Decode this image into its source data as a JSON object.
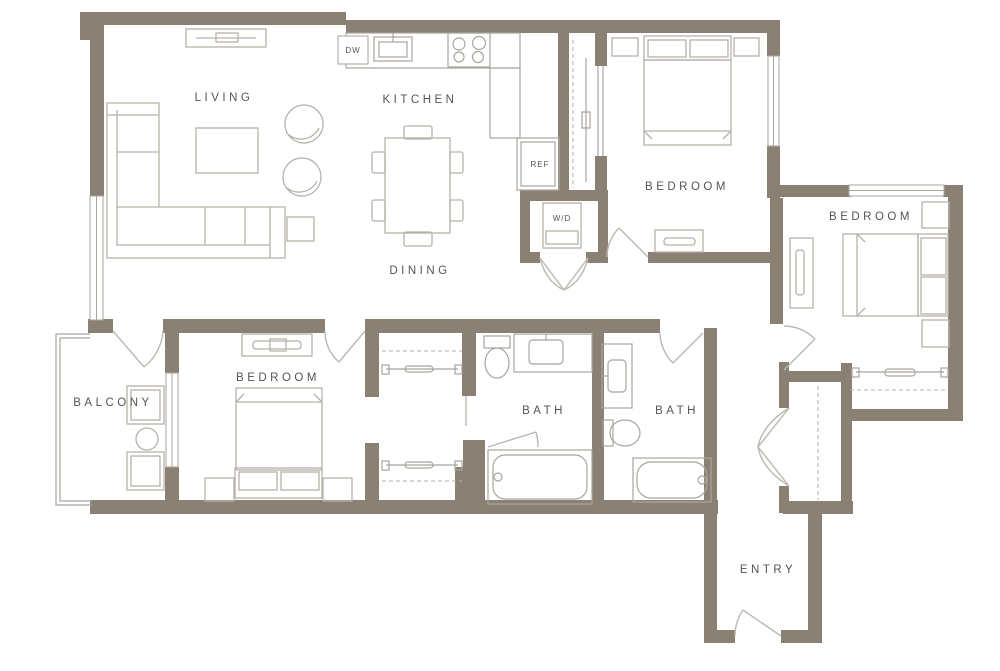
{
  "document": {
    "type": "apartment-floor-plan"
  },
  "colors": {
    "wall": "#8a8174",
    "furniture_line": "#b6b2a9",
    "fixture_line": "#a9a59c",
    "text": "#57544b",
    "background": "#ffffff"
  },
  "rooms": {
    "living": "LIVING",
    "kitchen": "KITCHEN",
    "dining": "DINING",
    "bedroom_top": "BEDROOM",
    "bedroom_right": "BEDROOM",
    "bedroom_left": "BEDROOM",
    "balcony": "BALCONY",
    "bath_main": "BATH",
    "bath_second": "BATH",
    "entry": "ENTRY"
  },
  "labels": {
    "dishwasher": "DW",
    "refrigerator": "REF",
    "washer_dryer": "W/D"
  }
}
